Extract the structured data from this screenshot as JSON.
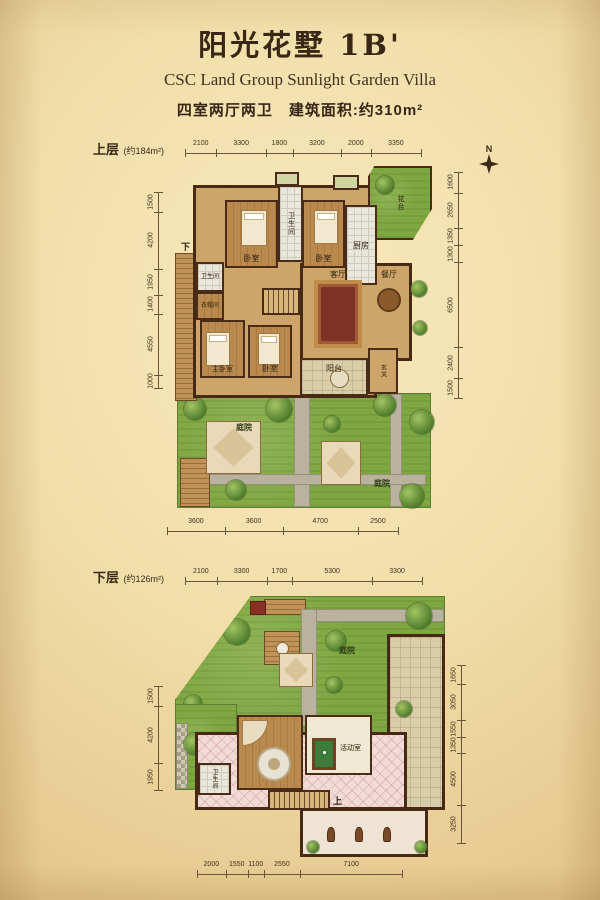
{
  "header": {
    "title": "阳光花墅 1B'",
    "subtitle": "CSC Land Group Sunlight Garden Villa",
    "spec": "四室两厅两卫　建筑面积:约310m²"
  },
  "compass": {
    "label": "N"
  },
  "upper": {
    "label": "上层",
    "area": "(约184m²)",
    "dims_top": [
      "2100",
      "3300",
      "1800",
      "3200",
      "2000",
      "3350"
    ],
    "dims_left": [
      "1500",
      "4200",
      "1950",
      "1400",
      "4550",
      "1000"
    ],
    "dims_right": [
      "1600",
      "2650",
      "1350",
      "1300",
      "6500",
      "2400",
      "1500"
    ],
    "dims_bottom": [
      "3600",
      "3600",
      "4700",
      "2500"
    ],
    "rooms": {
      "bedroom_a": "卧室",
      "bath_top": "卫生间",
      "bedroom_b": "卧室",
      "kitchen": "厨房",
      "flower_bed": "花台",
      "bath_left": "卫生间",
      "cloakroom": "衣帽间",
      "stairs_down": "下",
      "master_bedroom": "主卧室",
      "bedroom_c": "卧室",
      "living": "客厅",
      "dining": "餐厅",
      "balcony": "阳台",
      "foyer": "玄关",
      "courtyard": "庭院"
    }
  },
  "lower": {
    "label": "下层",
    "area": "(约126m²)",
    "dims_top": [
      "2100",
      "3300",
      "1700",
      "5300",
      "3300"
    ],
    "dims_left": [
      "1500",
      "4200",
      "1950"
    ],
    "dims_right": [
      "1650",
      "3050",
      "1550",
      "1350",
      "4500",
      "3250"
    ],
    "dims_bottom": [
      "2000",
      "1550",
      "1100",
      "2550",
      "7100"
    ],
    "rooms": {
      "courtyard": "庭院",
      "activity": "活动室",
      "bath": "卫生间",
      "stairs_up": "上"
    }
  }
}
